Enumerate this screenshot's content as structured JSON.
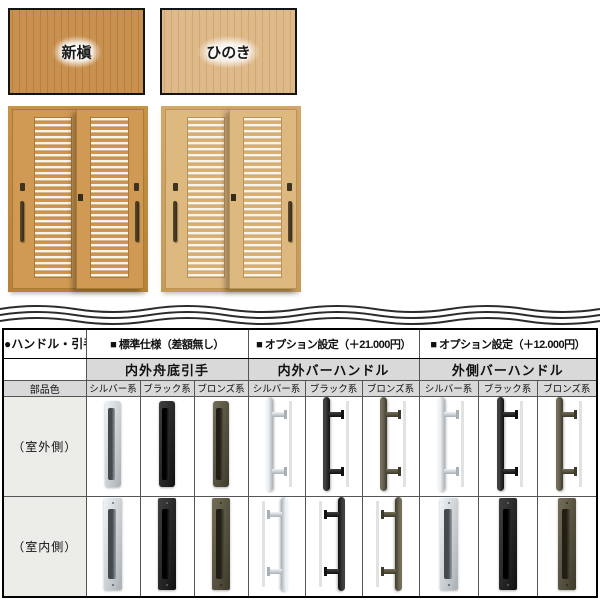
{
  "swatches": [
    {
      "label": "新槇",
      "base": "#c99150",
      "streak": "#b97f3e"
    },
    {
      "label": "ひのき",
      "base": "#deba8a",
      "streak": "#d0a873"
    }
  ],
  "doors": [
    {
      "name": "shinmaki",
      "frame": "#c79247",
      "frame2": "#b8823a",
      "panel": "#d09a54",
      "slat": "#cc964e",
      "line": "#a87a36"
    },
    {
      "name": "hinoki",
      "frame": "#d3a868",
      "frame2": "#c69a58",
      "panel": "#ddb87f",
      "slat": "#d9b074",
      "line": "#bb9258"
    }
  ],
  "table": {
    "corner_label": "●ハンドル・引手",
    "part_color_label": "部品色",
    "groups": [
      {
        "header": "■ 標準仕様（差額無し）",
        "subheader": "内外舟底引手",
        "finishes": [
          "シルバー系",
          "ブラック系",
          "ブロンズ系"
        ]
      },
      {
        "header": "■ オプション設定（＋21.000円）",
        "subheader": "内外バーハンドル",
        "finishes": [
          "シルバー系",
          "ブラック系",
          "ブロンズ系"
        ]
      },
      {
        "header": "■ オプション設定（＋12.000円）",
        "subheader": "外側バーハンドル",
        "finishes": [
          "シルバー系",
          "ブラック系",
          "ブロンズ系"
        ]
      }
    ],
    "rows": [
      {
        "label": "（室外側）",
        "cells": [
          {
            "type": "flush",
            "finish": "silver"
          },
          {
            "type": "flush",
            "finish": "black"
          },
          {
            "type": "flush",
            "finish": "bronze"
          },
          {
            "type": "bar",
            "finish": "silver"
          },
          {
            "type": "bar",
            "finish": "black"
          },
          {
            "type": "bar",
            "finish": "bronze"
          },
          {
            "type": "bar",
            "finish": "silver"
          },
          {
            "type": "bar",
            "finish": "black"
          },
          {
            "type": "bar",
            "finish": "bronze"
          }
        ]
      },
      {
        "label": "（室内側）",
        "cells": [
          {
            "type": "flush-long",
            "finish": "silver"
          },
          {
            "type": "flush-long",
            "finish": "black"
          },
          {
            "type": "flush-long",
            "finish": "bronze"
          },
          {
            "type": "bar-mirrored",
            "finish": "silver"
          },
          {
            "type": "bar-mirrored",
            "finish": "black"
          },
          {
            "type": "bar-mirrored",
            "finish": "bronze"
          },
          {
            "type": "flush-long",
            "finish": "silver"
          },
          {
            "type": "flush-long",
            "finish": "black"
          },
          {
            "type": "flush-long",
            "finish": "bronze"
          }
        ]
      }
    ]
  },
  "finish_colors": {
    "silver": "#c8cdd1",
    "black": "#1c1c1c",
    "bronze": "#57523f"
  }
}
